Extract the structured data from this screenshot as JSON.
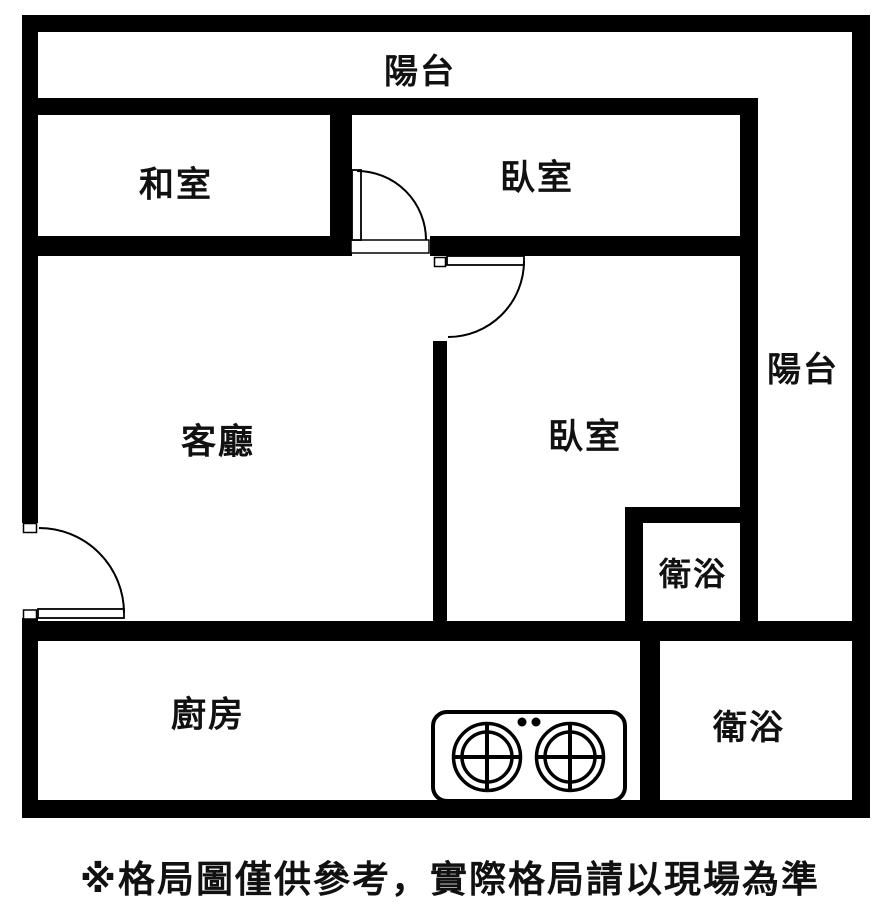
{
  "colors": {
    "wall": "#000000",
    "floor": "#ffffff",
    "ink": "#111111"
  },
  "rooms": {
    "balcony_top": {
      "label": "陽台"
    },
    "tatami": {
      "label": "和室"
    },
    "bedroom_top": {
      "label": "臥室"
    },
    "balcony_right": {
      "label": "陽台"
    },
    "living": {
      "label": "客廳"
    },
    "bedroom_main": {
      "label": "臥室"
    },
    "bath_small": {
      "label": "衛浴"
    },
    "kitchen": {
      "label": "廚房"
    },
    "bath_large": {
      "label": "衛浴"
    }
  },
  "fixtures": {
    "stove": {
      "name": "two-burner gas stove",
      "burner_count": 2
    }
  },
  "footer": {
    "disclaimer": "※格局圖僅供參考，實際格局請以現場為準"
  }
}
